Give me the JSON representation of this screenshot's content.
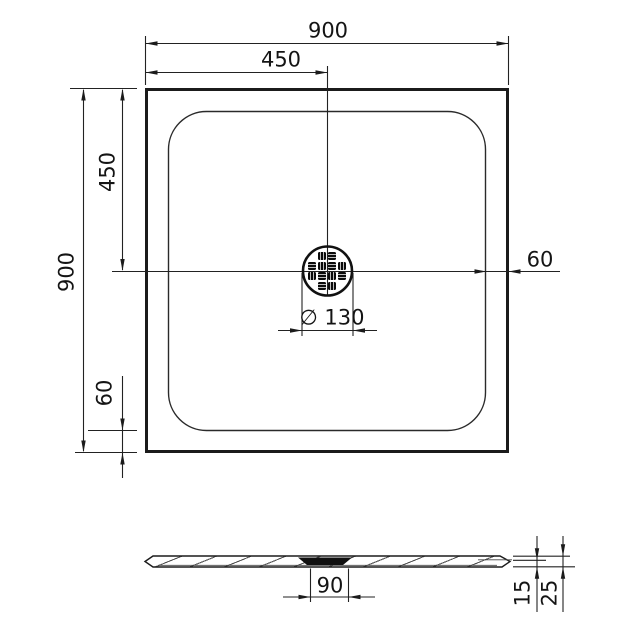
{
  "dimensions": {
    "top_width": "900",
    "top_half_width": "450",
    "left_height": "900",
    "left_half_height": "450",
    "left_edge_inset": "60",
    "right_edge_inset": "60",
    "drain_diameter": "∅ 130",
    "side_drain_width": "90",
    "side_rim_height": "15",
    "side_total_height": "25"
  },
  "colors": {
    "line": "#1b1b1b",
    "background": "#ffffff",
    "drain_fill": "#101010"
  }
}
